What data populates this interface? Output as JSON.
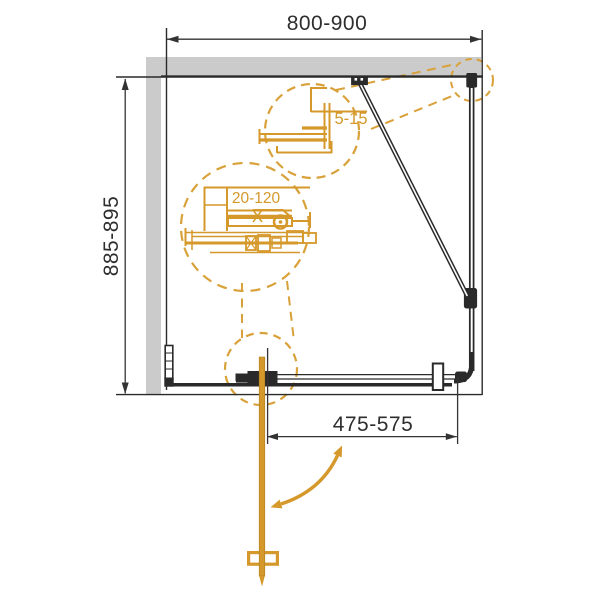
{
  "drawing": {
    "labels": {
      "top_width": "800-900",
      "side_depth": "885-895",
      "door_width": "475-575",
      "detail_wall_profile": "5-15",
      "detail_adjustment": "20-120"
    },
    "colors": {
      "wall_gray": "#cbcbcb",
      "line_black": "#2a2a2a",
      "dim_black": "#333333",
      "gold_solid": "#d5982a",
      "gold_dashed": "#d9a139"
    }
  }
}
